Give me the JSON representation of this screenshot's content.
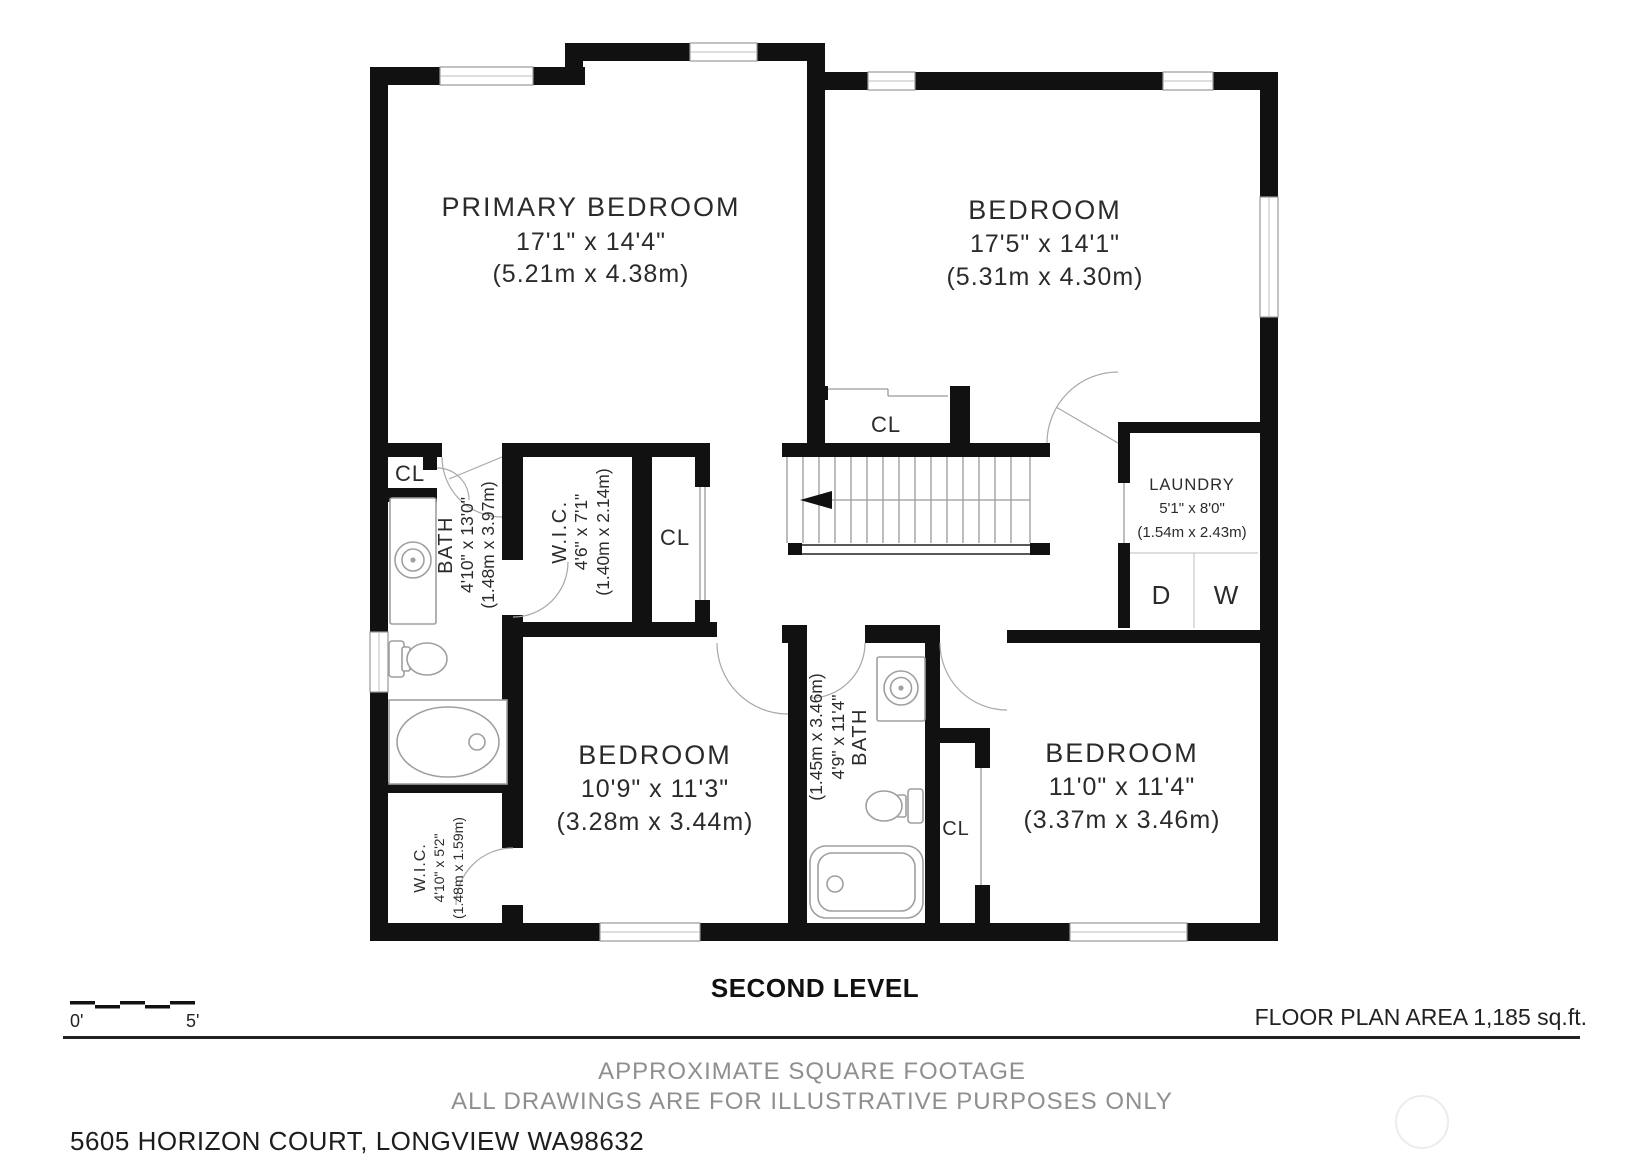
{
  "plan": {
    "level_title": "SECOND LEVEL",
    "area_note": "FLOOR PLAN AREA 1,185 sq.ft.",
    "disclaimer_line1": "APPROXIMATE SQUARE FOOTAGE",
    "disclaimer_line2": "ALL DRAWINGS ARE FOR ILLUSTRATIVE PURPOSES ONLY",
    "address": "5605 HORIZON COURT, LONGVIEW WA98632",
    "scale_bar": {
      "start_label": "0'",
      "end_label": "5'"
    }
  },
  "rooms": {
    "primary_bedroom": {
      "name": "PRIMARY BEDROOM",
      "dims_ft": "17'1\" x 14'4\"",
      "dims_m": "(5.21m x 4.38m)"
    },
    "bedroom_top_right": {
      "name": "BEDROOM",
      "dims_ft": "17'5\" x 14'1\"",
      "dims_m": "(5.31m x 4.30m)"
    },
    "bedroom_bottom_left": {
      "name": "BEDROOM",
      "dims_ft": "10'9\" x 11'3\"",
      "dims_m": "(3.28m x 3.44m)"
    },
    "bedroom_bottom_right": {
      "name": "BEDROOM",
      "dims_ft": "11'0\" x 11'4\"",
      "dims_m": "(3.37m x 3.46m)"
    },
    "laundry": {
      "name": "LAUNDRY",
      "dims_ft": "5'1\" x 8'0\"",
      "dims_m": "(1.54m x 2.43m)"
    },
    "bath_left": {
      "name": "BATH",
      "dims_ft": "4'10\" x 13'0\"",
      "dims_m": "(1.48m x 3.97m)"
    },
    "bath_middle": {
      "name": "BATH",
      "dims_ft": "4'9\" x 11'4\"",
      "dims_m": "(1.45m x 3.46m)"
    },
    "wic_top": {
      "name": "W.I.C.",
      "dims_ft": "4'6\" x 7'1\"",
      "dims_m": "(1.40m x 2.14m)"
    },
    "wic_bottom": {
      "name": "W.I.C.",
      "dims_ft": "4'10\" x 5'2\"",
      "dims_m": "(1.48m x 1.59m)"
    }
  },
  "closet": {
    "label": "CL"
  },
  "appliances": {
    "dryer": "D",
    "washer": "W"
  },
  "colors": {
    "wall": "#111111",
    "thin_line": "#9a9a9a",
    "muted_text": "#8f8f8f"
  }
}
